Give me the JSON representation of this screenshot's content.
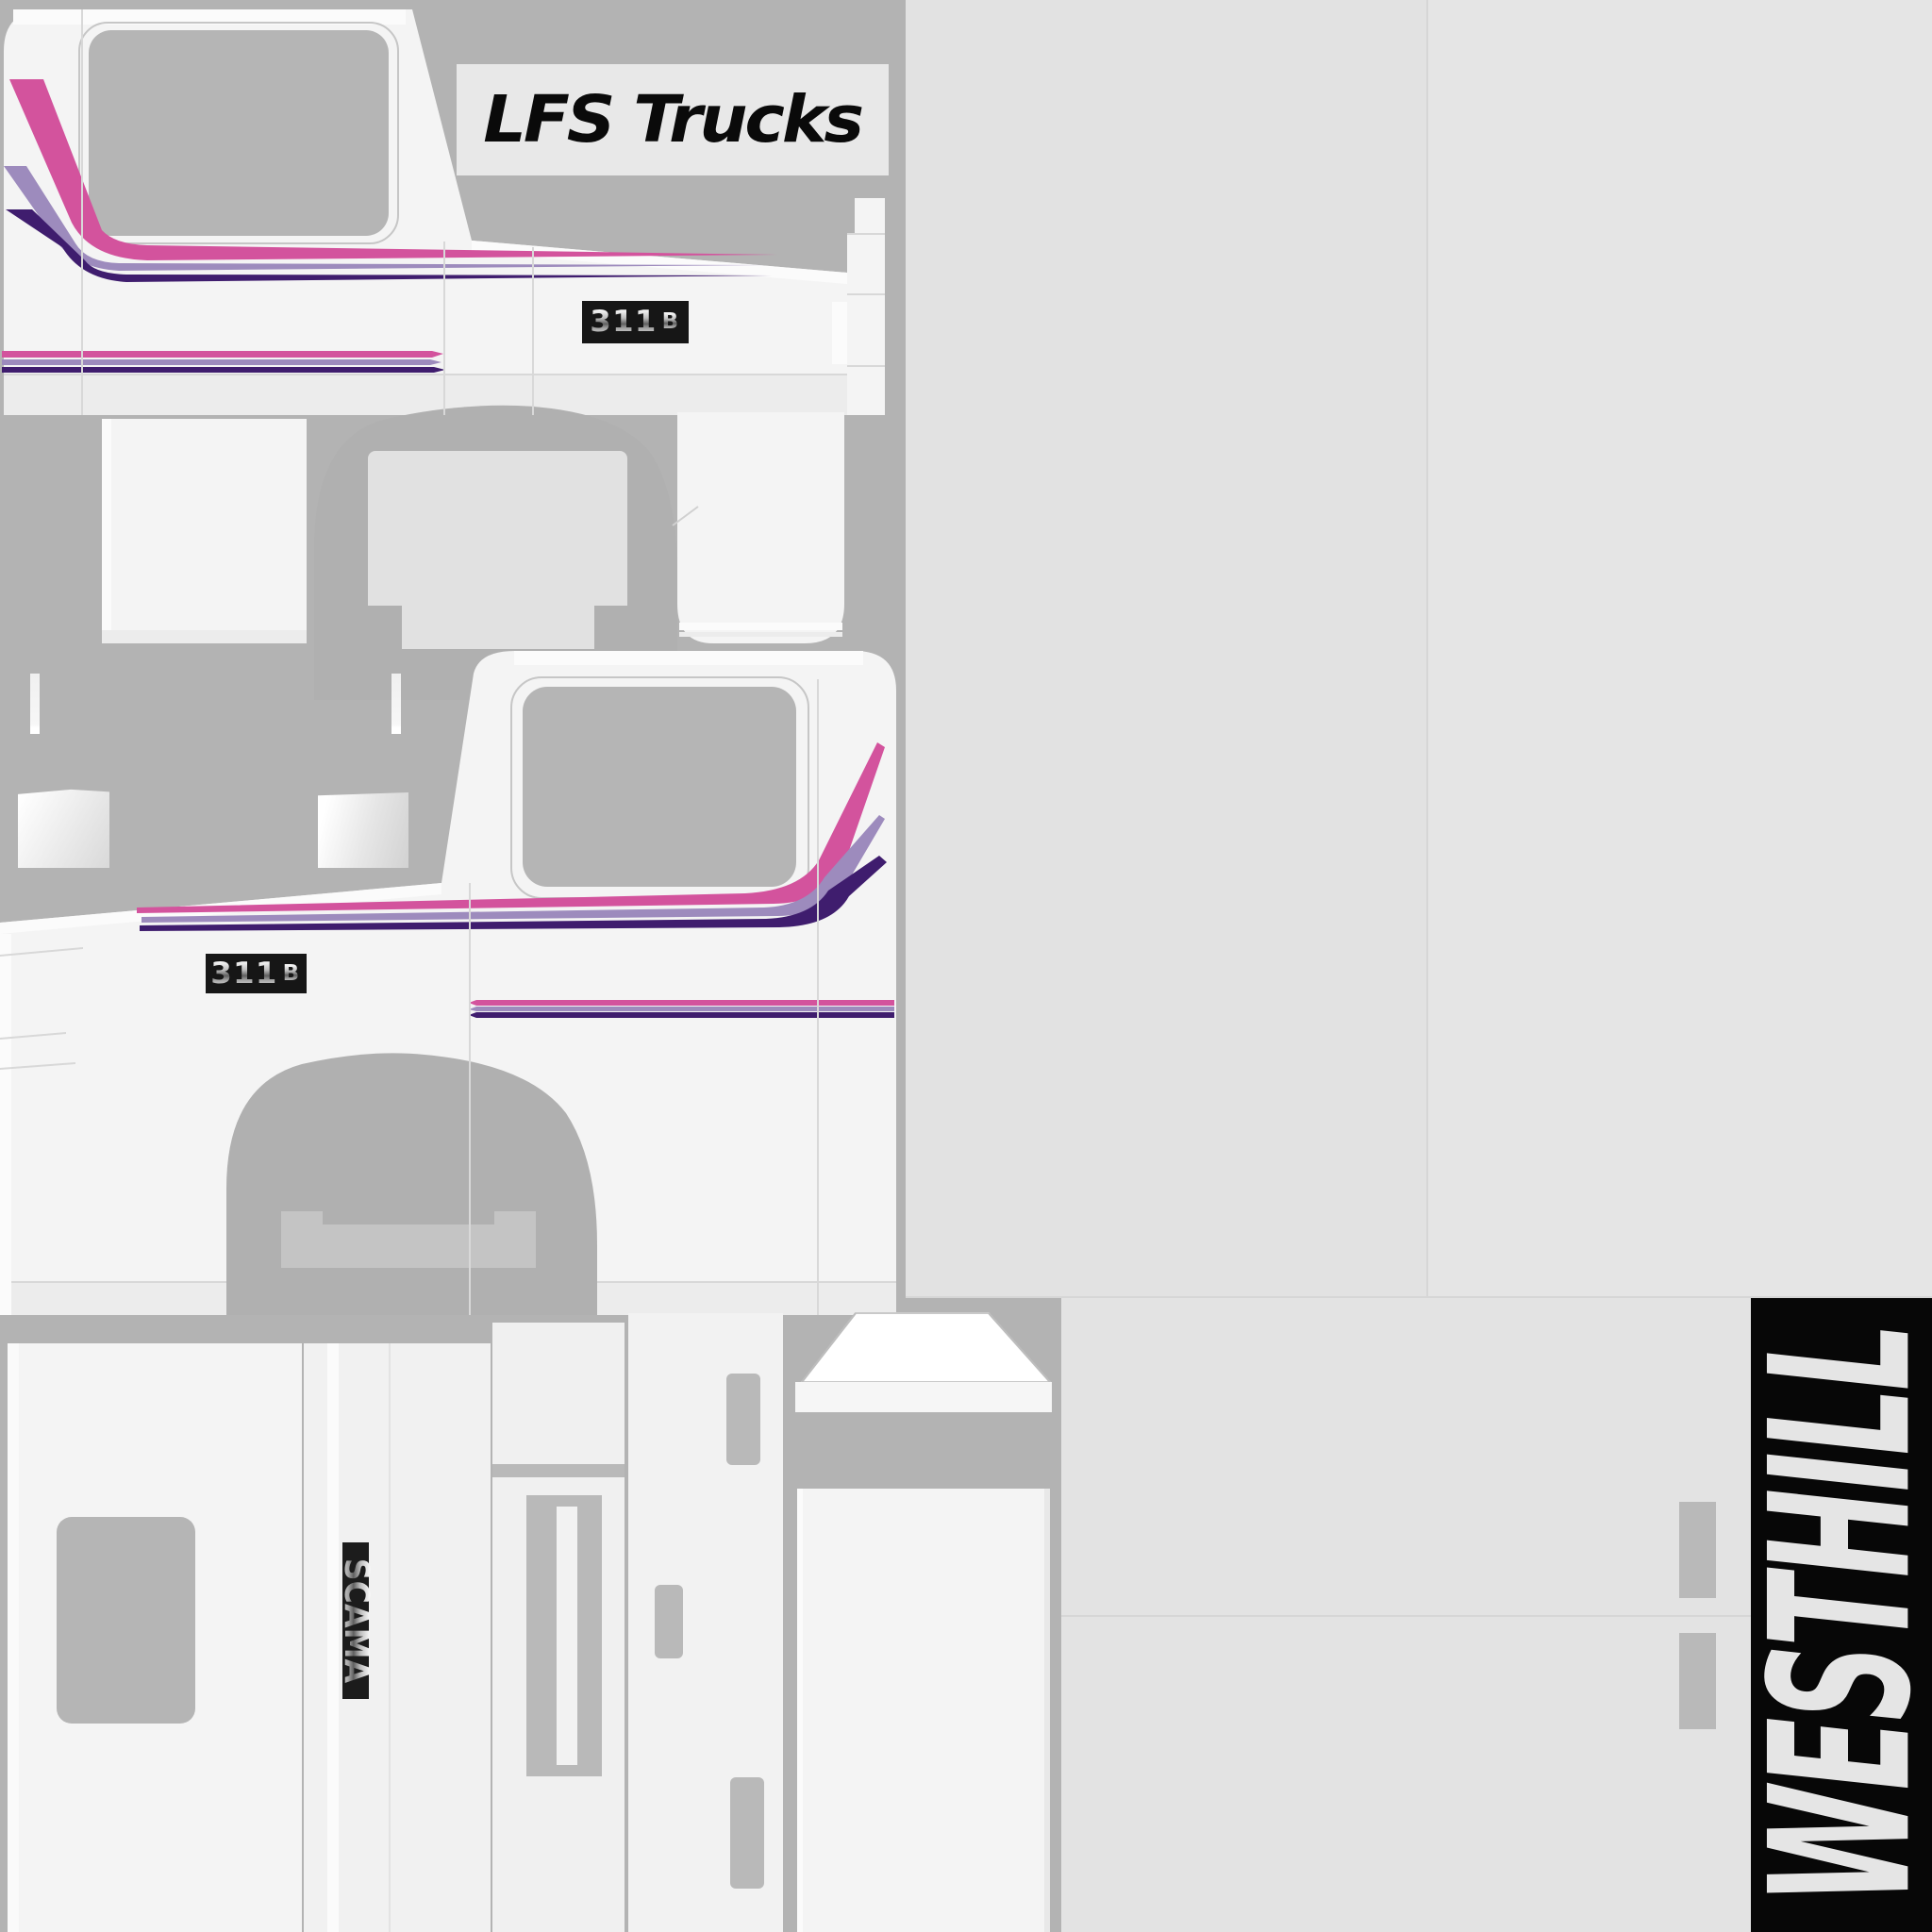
{
  "sheet": {
    "brand_label": "LFS Trucks",
    "model_badge": {
      "number": "311",
      "letter": "B"
    },
    "manufacturer_badge": "SCAMA",
    "location_banner": "WESTHILL"
  },
  "colors": {
    "background": "#b3b3b3",
    "panel_gray_light": "#e3e3e3",
    "panel_gray_left": "#e2e2e2",
    "panel_gray_right": "#e5e5e5",
    "seam": "#d6d6d6",
    "cab_white": "#f4f4f4",
    "cab_shade": "#ececec",
    "cab_highlight": "#fbfbfb",
    "window_gray": "#b5b5b5",
    "window_outline": "#c6c6c6",
    "stripe_pink": "#d3539d",
    "stripe_lavender": "#9d8bbd",
    "stripe_purple": "#3f1d6e",
    "badge_bg": "#161616",
    "metal_light": "#fdfdfd",
    "metal_dark": "#5f5f5f",
    "banner_bg": "#070707",
    "banner_text": "#e5e5e5",
    "label_bg": "#e8e8e8",
    "label_text": "#0a0a0a",
    "arch_gray": "#b0b0b0",
    "arch_inner": "#e1e1e1",
    "cutout_gray": "#b9b9b9"
  }
}
